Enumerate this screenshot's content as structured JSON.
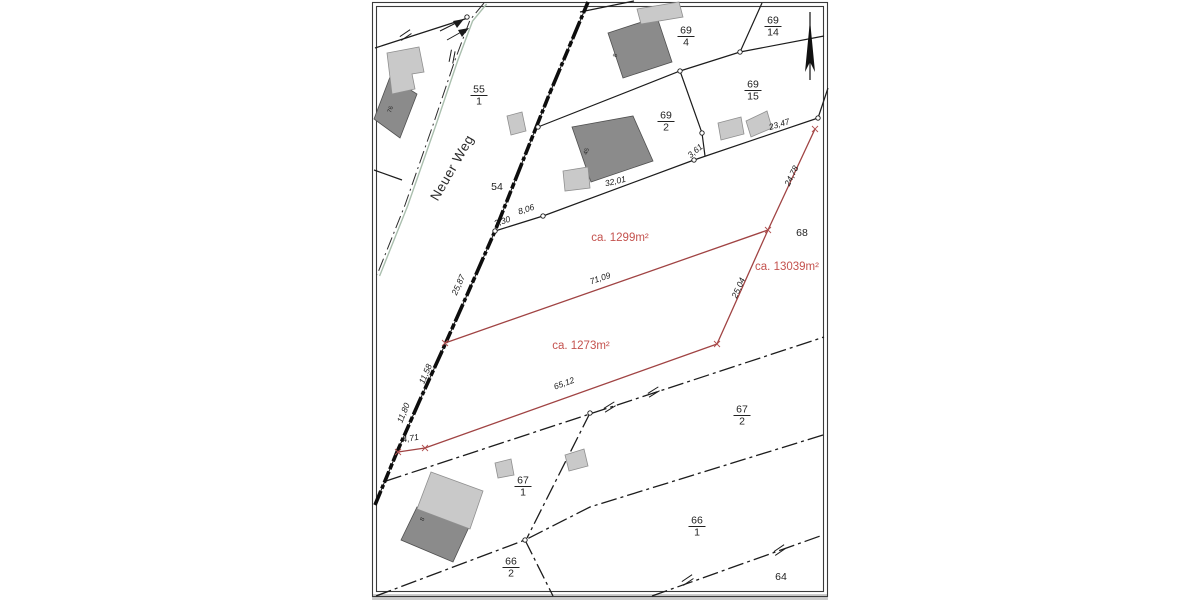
{
  "title": "cadastral-parcel-map",
  "colors": {
    "red_line": "#a04343",
    "red_text": "#c4524e",
    "dark_building": "#8b8b8b",
    "light_building": "#c9c9c9",
    "boundary_line": "#1c1c1c",
    "sheet_background": "#ffffff"
  },
  "street": {
    "name": "Neuer Weg",
    "x": 456,
    "y": 170,
    "rot": -60
  },
  "north_arrow": {
    "x": 810,
    "y1": 12,
    "y2": 80
  },
  "parcel_fractions": [
    {
      "num": "55",
      "den": "1",
      "x": 479,
      "y": 95
    },
    {
      "num": "69",
      "den": "4",
      "x": 686,
      "y": 36
    },
    {
      "num": "69",
      "den": "14",
      "x": 773,
      "y": 26
    },
    {
      "num": "69",
      "den": "15",
      "x": 753,
      "y": 90
    },
    {
      "num": "69",
      "den": "2",
      "x": 666,
      "y": 121
    },
    {
      "num": "67",
      "den": "1",
      "x": 523,
      "y": 486
    },
    {
      "num": "67",
      "den": "2",
      "x": 742,
      "y": 415
    },
    {
      "num": "66",
      "den": "1",
      "x": 697,
      "y": 526
    },
    {
      "num": "66",
      "den": "2",
      "x": 511,
      "y": 567
    }
  ],
  "parcel_plain": [
    {
      "text": "54",
      "x": 497,
      "y": 190
    },
    {
      "text": "68",
      "x": 802,
      "y": 236
    },
    {
      "text": "64",
      "x": 781,
      "y": 580
    }
  ],
  "area_labels": [
    {
      "text": "ca. 1299m²",
      "x": 620,
      "y": 241
    },
    {
      "text": "ca. 13039m²",
      "x": 787,
      "y": 270
    },
    {
      "text": "ca. 1273m²",
      "x": 581,
      "y": 349
    }
  ],
  "measurements": [
    {
      "text": "3,30",
      "x": 503,
      "y": 224,
      "rot": -18
    },
    {
      "text": "8,06",
      "x": 527,
      "y": 212,
      "rot": -18
    },
    {
      "text": "32,01",
      "x": 616,
      "y": 184,
      "rot": -13
    },
    {
      "text": "3,61",
      "x": 697,
      "y": 153,
      "rot": -40
    },
    {
      "text": "23,47",
      "x": 780,
      "y": 127,
      "rot": -17
    },
    {
      "text": "24,78",
      "x": 794,
      "y": 177,
      "rot": -64
    },
    {
      "text": "71,09",
      "x": 601,
      "y": 281,
      "rot": -19
    },
    {
      "text": "25,04",
      "x": 741,
      "y": 289,
      "rot": -66
    },
    {
      "text": "65,12",
      "x": 565,
      "y": 386,
      "rot": -20
    },
    {
      "text": "25,87",
      "x": 461,
      "y": 286,
      "rot": -66
    },
    {
      "text": "11,58",
      "x": 428,
      "y": 375,
      "rot": -67
    },
    {
      "text": "11,80",
      "x": 406,
      "y": 414,
      "rot": -68
    },
    {
      "text": "4,71",
      "x": 411,
      "y": 441,
      "rot": -10
    }
  ],
  "building_numbers": [
    {
      "text": "76",
      "x": 392,
      "y": 110,
      "rot": -70
    },
    {
      "text": "8",
      "x": 617,
      "y": 56,
      "rot": -70
    },
    {
      "text": "45",
      "x": 588,
      "y": 152,
      "rot": -70
    },
    {
      "text": "8",
      "x": 424,
      "y": 520,
      "rot": -65
    }
  ],
  "geometry": {
    "frame_outer": [
      372.5,
      2.5,
      455,
      594
    ],
    "frame_inner": [
      376.5,
      6.5,
      447,
      585
    ],
    "gray_strip": [
      372,
      594,
      456,
      6
    ],
    "lines_solid": [
      [
        [
          375,
          48
        ],
        [
          468,
          18
        ]
      ],
      [
        [
          374,
          170
        ],
        [
          402,
          180
        ]
      ],
      [
        [
          495,
          231
        ],
        [
          543,
          216
        ],
        [
          694,
          160
        ],
        [
          818,
          118
        ]
      ],
      [
        [
          818,
          118
        ],
        [
          828,
          88
        ]
      ],
      [
        [
          538,
          127
        ],
        [
          680,
          71
        ],
        [
          740,
          52
        ],
        [
          824,
          36
        ]
      ],
      [
        [
          740,
          52
        ],
        [
          762,
          3
        ]
      ],
      [
        [
          680,
          71
        ],
        [
          702,
          133
        ],
        [
          705,
          156
        ]
      ],
      [
        [
          580,
          12
        ],
        [
          634,
          1
        ]
      ]
    ],
    "lines_dashdot": [
      [
        [
          386,
          481
        ],
        [
          824,
          337
        ]
      ],
      [
        [
          590,
          413
        ],
        [
          527,
          538
        ]
      ],
      [
        [
          823,
          435
        ],
        [
          590,
          507
        ],
        [
          525,
          540
        ]
      ],
      [
        [
          525,
          540
        ],
        [
          553,
          596
        ]
      ],
      [
        [
          376,
          596
        ],
        [
          440,
          572
        ],
        [
          525,
          540
        ]
      ],
      [
        [
          652,
          596
        ],
        [
          823,
          535
        ]
      ]
    ],
    "west_edge": [
      [
        484,
        3
      ],
      [
        470,
        20
      ],
      [
        455,
        60
      ],
      [
        433,
        125
      ],
      [
        405,
        205
      ],
      [
        385,
        255
      ],
      [
        377,
        275
      ]
    ],
    "bold_street": [
      [
        588,
        2
      ],
      [
        549,
        95
      ],
      [
        495,
        231
      ],
      [
        467,
        295
      ],
      [
        443,
        349
      ],
      [
        419,
        402
      ],
      [
        397,
        452
      ],
      [
        375,
        505
      ]
    ],
    "red_lines": [
      [
        [
          815,
          129
        ],
        [
          768,
          230
        ]
      ],
      [
        [
          768,
          230
        ],
        [
          445,
          343
        ]
      ],
      [
        [
          768,
          230
        ],
        [
          717,
          344
        ]
      ],
      [
        [
          717,
          344
        ],
        [
          425,
          448
        ]
      ],
      [
        [
          425,
          448
        ],
        [
          398,
          452
        ]
      ]
    ],
    "red_points": [
      [
        815,
        129
      ],
      [
        768,
        230
      ],
      [
        717,
        344
      ],
      [
        445,
        343
      ],
      [
        425,
        448
      ],
      [
        398,
        452
      ]
    ],
    "junction_circles": [
      [
        467,
        17
      ],
      [
        495,
        231
      ],
      [
        538,
        127
      ],
      [
        543,
        216
      ],
      [
        694,
        160
      ],
      [
        680,
        71
      ],
      [
        702,
        133
      ],
      [
        740,
        52
      ],
      [
        818,
        118
      ],
      [
        590,
        413
      ],
      [
        525,
        540
      ]
    ],
    "double_ticks": [
      {
        "x": 406,
        "y": 36,
        "rot": -20
      },
      {
        "x": 453,
        "y": 57,
        "rot": -65
      },
      {
        "x": 610,
        "y": 408,
        "rot": -18
      },
      {
        "x": 654,
        "y": 393,
        "rot": -18
      },
      {
        "x": 688,
        "y": 581,
        "rot": -20
      },
      {
        "x": 780,
        "y": 551,
        "rot": -20
      }
    ],
    "arrows": [
      {
        "line": [
          440,
          31,
          458,
          22
        ],
        "head": [
          [
            464,
            19
          ],
          [
            453,
            21
          ],
          [
            457,
            28
          ]
        ]
      },
      {
        "line": [
          447,
          40,
          463,
          31
        ],
        "head": [
          [
            469,
            28
          ],
          [
            458,
            30
          ],
          [
            462,
            37
          ]
        ]
      }
    ],
    "buildings_dark": [
      [
        [
          390,
          77
        ],
        [
          417,
          94
        ],
        [
          400,
          138
        ],
        [
          374,
          119
        ]
      ],
      [
        [
          608,
          33
        ],
        [
          657,
          17
        ],
        [
          672,
          62
        ],
        [
          623,
          78
        ]
      ],
      [
        [
          572,
          127
        ],
        [
          633,
          116
        ],
        [
          653,
          161
        ],
        [
          591,
          182
        ]
      ],
      [
        [
          417,
          507
        ],
        [
          469,
          527
        ],
        [
          453,
          562
        ],
        [
          401,
          540
        ]
      ]
    ],
    "buildings_light": [
      [
        [
          387,
          53
        ],
        [
          419,
          47
        ],
        [
          424,
          72
        ],
        [
          412,
          74
        ],
        [
          415,
          89
        ],
        [
          392,
          94
        ]
      ],
      [
        [
          637,
          9
        ],
        [
          679,
          2
        ],
        [
          683,
          17
        ],
        [
          641,
          24
        ]
      ],
      [
        [
          431,
          472
        ],
        [
          483,
          491
        ],
        [
          470,
          529
        ],
        [
          417,
          509
        ]
      ],
      [
        [
          507,
          116
        ],
        [
          522,
          112
        ],
        [
          526,
          131
        ],
        [
          511,
          135
        ]
      ],
      [
        [
          563,
          171
        ],
        [
          588,
          167
        ],
        [
          590,
          188
        ],
        [
          565,
          191
        ]
      ],
      [
        [
          718,
          123
        ],
        [
          741,
          117
        ],
        [
          744,
          134
        ],
        [
          721,
          140
        ]
      ],
      [
        [
          746,
          121
        ],
        [
          767,
          111
        ],
        [
          772,
          128
        ],
        [
          751,
          137
        ]
      ],
      [
        [
          495,
          463
        ],
        [
          511,
          459
        ],
        [
          514,
          475
        ],
        [
          498,
          478
        ]
      ],
      [
        [
          565,
          455
        ],
        [
          584,
          449
        ],
        [
          588,
          466
        ],
        [
          569,
          471
        ]
      ]
    ]
  }
}
